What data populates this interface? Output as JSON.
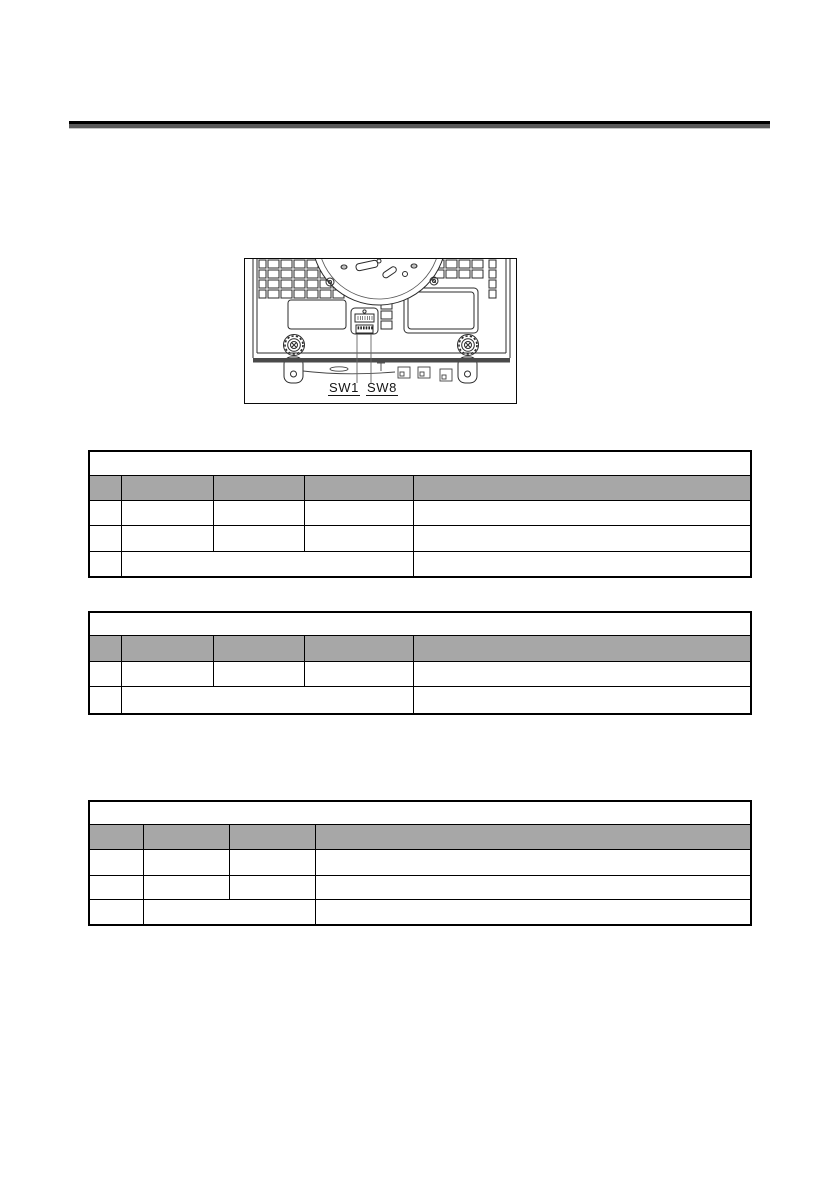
{
  "figure": {
    "caption_labels": {
      "sw1": "SW1",
      "sw8": "SW8"
    }
  },
  "tables": {
    "table1": {
      "title": "",
      "headers": [
        "",
        "",
        "",
        "",
        ""
      ],
      "rows": [
        [
          "",
          "",
          "",
          "",
          ""
        ],
        [
          "",
          "",
          "",
          "",
          ""
        ],
        [
          "",
          "",
          ""
        ]
      ]
    },
    "table2": {
      "title": "",
      "headers": [
        "",
        "",
        "",
        "",
        ""
      ],
      "rows": [
        [
          "",
          "",
          "",
          "",
          ""
        ],
        [
          "",
          "",
          ""
        ]
      ]
    },
    "table3": {
      "title": "",
      "headers": [
        "",
        "",
        "",
        ""
      ],
      "rows": [
        [
          "",
          "",
          "",
          ""
        ],
        [
          "",
          "",
          "",
          ""
        ],
        [
          "",
          "",
          ""
        ]
      ]
    }
  },
  "colors": {
    "table_header_bg": "#a7a7a7",
    "table_border": "#000000",
    "rule_black": "#000000",
    "rule_gray": "#595959"
  }
}
